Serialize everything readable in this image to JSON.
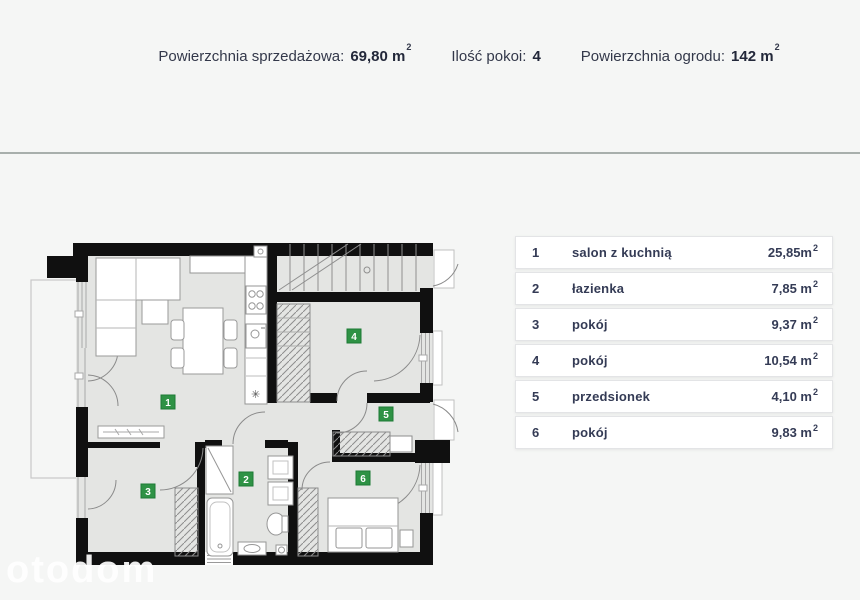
{
  "header": {
    "items": [
      {
        "label": "Powierzchnia sprzedażowa:",
        "value": "69,80 m",
        "sup": "2"
      },
      {
        "label": "Ilość pokoi:",
        "value": "4",
        "sup": ""
      },
      {
        "label": "Powierzchnia ogrodu:",
        "value": "142 m",
        "sup": "2"
      }
    ]
  },
  "legend": {
    "rows": [
      {
        "num": "1",
        "label": "salon z kuchnią",
        "area": "25,85m",
        "sup": "2"
      },
      {
        "num": "2",
        "label": "łazienka",
        "area": "7,85 m",
        "sup": "2"
      },
      {
        "num": "3",
        "label": "pokój",
        "area": "9,37 m",
        "sup": "2"
      },
      {
        "num": "4",
        "label": "pokój",
        "area": "10,54 m",
        "sup": "2"
      },
      {
        "num": "5",
        "label": "przedsionek",
        "area": "4,10 m",
        "sup": "2"
      },
      {
        "num": "6",
        "label": "pokój",
        "area": "9,83 m",
        "sup": "2"
      }
    ]
  },
  "watermark": "otodom",
  "colors": {
    "badge_green": "#2e9245",
    "divider": "#a8afac",
    "wall": "#101010",
    "interior": "#e4e5e3"
  }
}
